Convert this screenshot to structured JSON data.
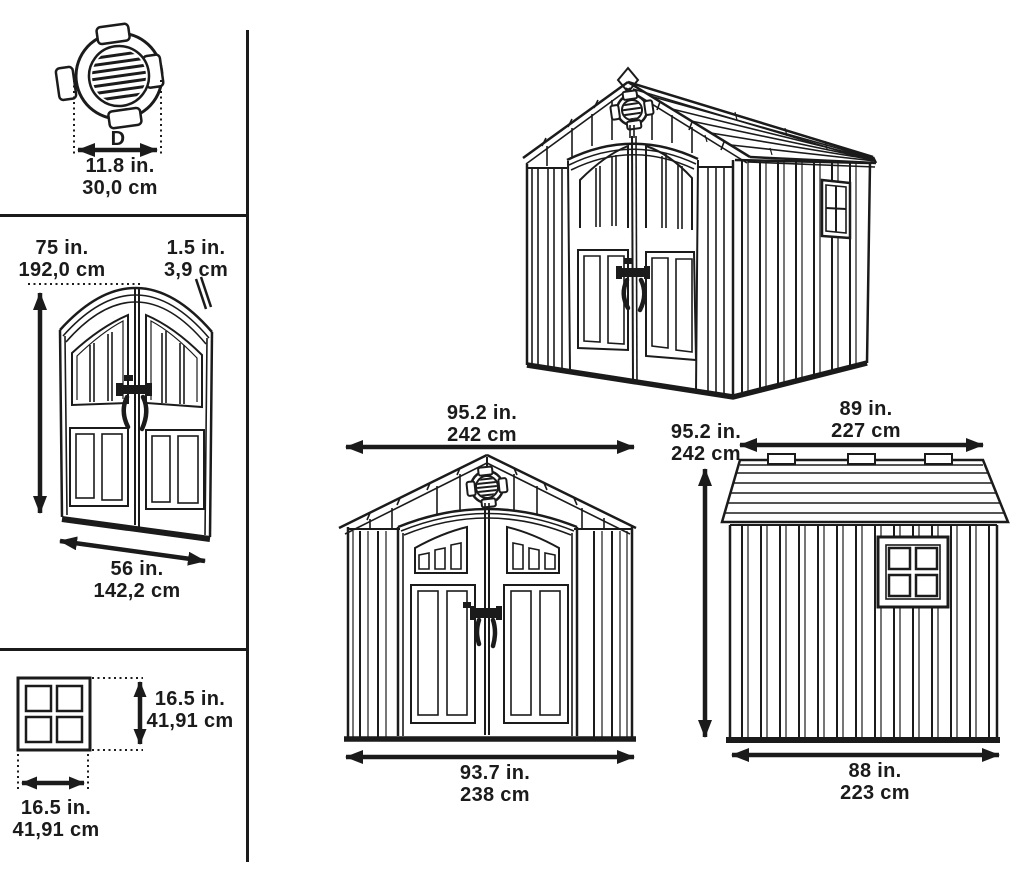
{
  "colors": {
    "line": "#1b1b1b",
    "background": "#ffffff"
  },
  "labels": {
    "vent_detail": {
      "letter": "D",
      "in": "11.8 in.",
      "cm": "30,0 cm"
    },
    "door_height": {
      "in": "75 in.",
      "cm": "192,0 cm"
    },
    "door_thickness": {
      "in": "1.5 in.",
      "cm": "3,9 cm"
    },
    "door_width": {
      "in": "56 in.",
      "cm": "142,2 cm"
    },
    "window_height": {
      "in": "16.5 in.",
      "cm": "41,91 cm"
    },
    "window_width": {
      "in": "16.5 in.",
      "cm": "41,91 cm"
    },
    "front_roof_width": {
      "in": "95.2 in.",
      "cm": "242 cm"
    },
    "front_base_width": {
      "in": "93.7 in.",
      "cm": "238 cm"
    },
    "side_height": {
      "in": "95.2 in.",
      "cm": "242 cm"
    },
    "side_roof_depth": {
      "in": "89 in.",
      "cm": "227 cm"
    },
    "side_base_depth": {
      "in": "88 in.",
      "cm": "223 cm"
    }
  }
}
